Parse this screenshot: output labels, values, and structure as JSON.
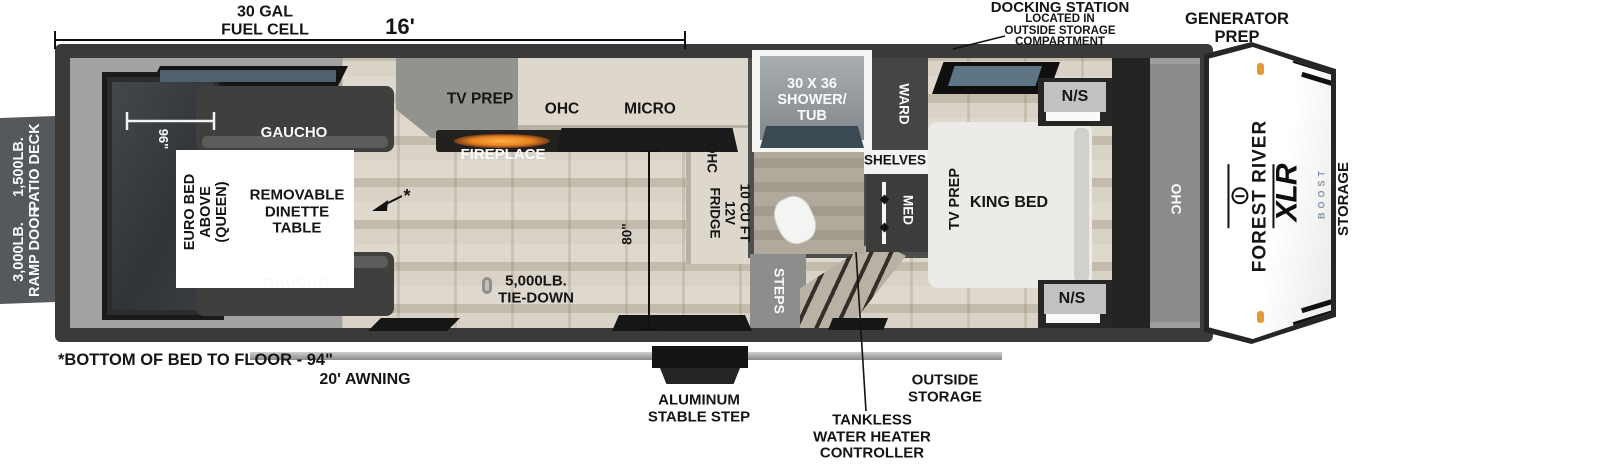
{
  "measurements": {
    "fuel_cell": "30 GAL\nFUEL CELL",
    "length": "16'",
    "garage_width": "96\"",
    "cargo_height": "80\"",
    "bed_floor_note": "*BOTTOM OF BED TO FLOOR - 94\"",
    "awning": "20' AWNING"
  },
  "callouts": {
    "docking_title": "DOCKING STATION",
    "docking_detail": "LOCATED IN\nOUTSIDE STORAGE\nCOMPARTMENT",
    "generator_prep": "GENERATOR\nPREP",
    "patio_deck": "1,500LB.\nPATIO DECK",
    "ramp_door": "3,000LB.\nRAMP DOOR",
    "front_storage": "STORAGE",
    "outside_storage": "OUTSIDE\nSTORAGE",
    "stable_step": "ALUMINUM\nSTABLE STEP",
    "tankless": "TANKLESS\nWATER HEATER\nCONTROLLER"
  },
  "garage": {
    "gaucho_top": "GAUCHO",
    "gaucho_bottom": "GAUCHO",
    "euro_bed": "EURO BED\nABOVE\n(QUEEN)",
    "dinette": "REMOVABLE\nDINETTE\nTABLE",
    "note_marker": "*",
    "tie_down": "5,000LB.\nTIE-DOWN"
  },
  "living": {
    "tv_prep": "TV PREP",
    "fireplace": "FIREPLACE"
  },
  "kitchen": {
    "ohc": "OHC",
    "micro": "MICRO",
    "ohc_pantry": "OHC",
    "fridge": "10 CU FT\n12V\nFRIDGE",
    "steps": "STEPS"
  },
  "bath": {
    "shower": "30 X 36\nSHOWER/\nTUB",
    "shelves": "SHELVES",
    "med": "MED",
    "ward": "WARD"
  },
  "bedroom": {
    "tv_prep": "TV PREP",
    "king_bed": "KING BED",
    "ns_top": "N/S",
    "ns_bottom": "N/S",
    "ohc": "OHC"
  },
  "branding": {
    "make": "FOREST RIVER",
    "model": "XLR",
    "trim": "BOOST"
  },
  "colors": {
    "flame_accent": "#e8821e",
    "clearance_light": "#e09a35",
    "tv_screen": "#5d7585",
    "boost_logo": "#8195aa"
  }
}
